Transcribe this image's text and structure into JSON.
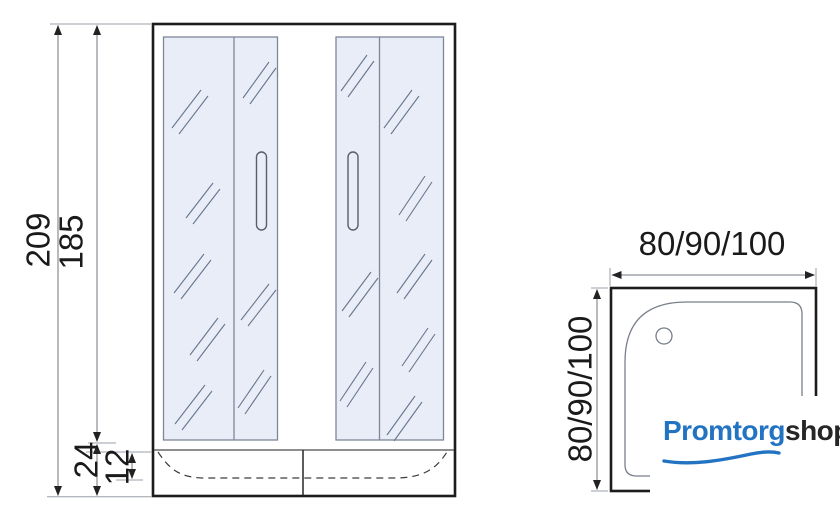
{
  "drawing": {
    "front_view": {
      "dim_total_height": "209",
      "dim_door_height": "185",
      "dim_tray_height": "24",
      "dim_tray_depth": "12"
    },
    "top_view": {
      "dim_width": "80/90/100",
      "dim_depth": "80/90/100"
    }
  },
  "logo": {
    "primary": "Promtorg",
    "secondary": "shop"
  },
  "colors": {
    "logo_blue": "#2273c2",
    "logo_dark": "#262626",
    "glass_fill": "#e9edf7",
    "glass_border": "#7e8798",
    "outline_dark": "#1c1c1c",
    "dim_line_gray": "#8d929b"
  },
  "icons": {
    "drain_hole": "drain-hole-icon",
    "door_handle": "door-handle-icon",
    "swoosh": "logo-swoosh-icon"
  }
}
